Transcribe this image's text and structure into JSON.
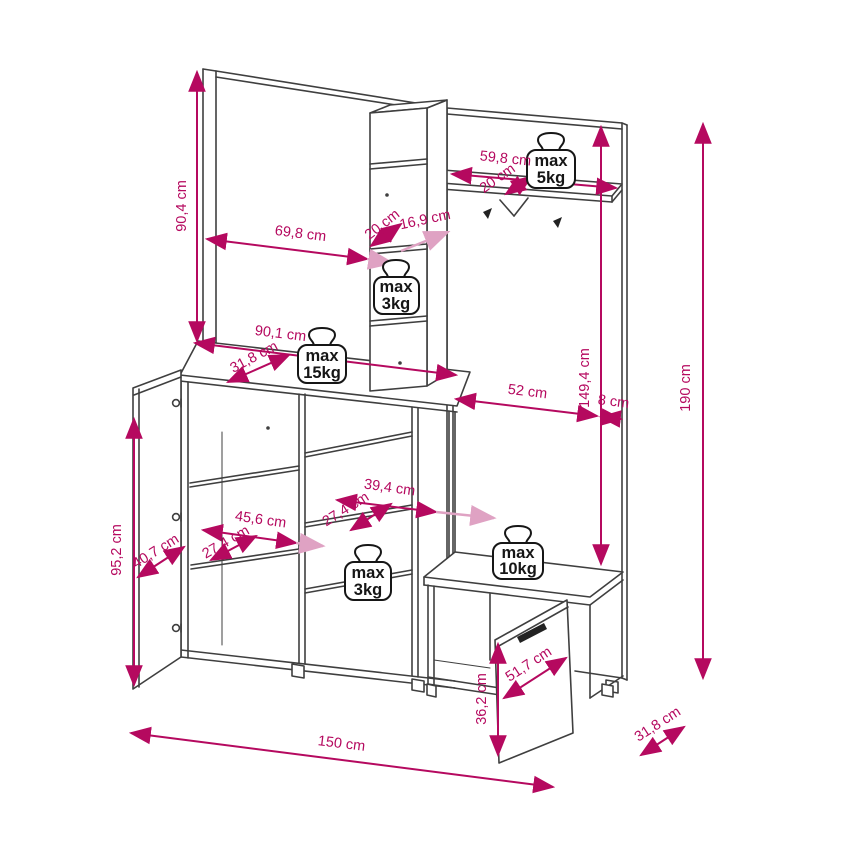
{
  "diagram": {
    "kind": "furniture dimension drawing",
    "unit": "cm"
  },
  "colors": {
    "dimension": "#b5095f",
    "dimension_light": "#dfa2c3",
    "furniture_line": "#3f3f3f",
    "badge": "#161616",
    "background": "#ffffff"
  },
  "labels": [
    {
      "text": "90,4 cm"
    },
    {
      "text": "69,8 cm"
    },
    {
      "text": "20 cm"
    },
    {
      "text": "16,9 cm"
    },
    {
      "text": "59,8 cm"
    },
    {
      "text": "20 cm"
    },
    {
      "text": "149,4 cm"
    },
    {
      "text": "52 cm"
    },
    {
      "text": "8 cm"
    },
    {
      "text": "190 cm"
    },
    {
      "text": "90,1 cm"
    },
    {
      "text": "31,8 cm"
    },
    {
      "text": "39,4 cm"
    },
    {
      "text": "27,4 cm"
    },
    {
      "text": "45,6 cm"
    },
    {
      "text": "27,4 cm"
    },
    {
      "text": "40,7 cm"
    },
    {
      "text": "95,2 cm"
    },
    {
      "text": "51,7 cm"
    },
    {
      "text": "36,2 cm"
    },
    {
      "text": "150 cm"
    },
    {
      "text": "31,8 cm"
    }
  ],
  "badges": [
    {
      "line1": "max",
      "line2": "5kg"
    },
    {
      "line1": "max",
      "line2": "3kg"
    },
    {
      "line1": "max",
      "line2": "15kg"
    },
    {
      "line1": "max",
      "line2": "3kg"
    },
    {
      "line1": "max",
      "line2": "10kg"
    }
  ]
}
